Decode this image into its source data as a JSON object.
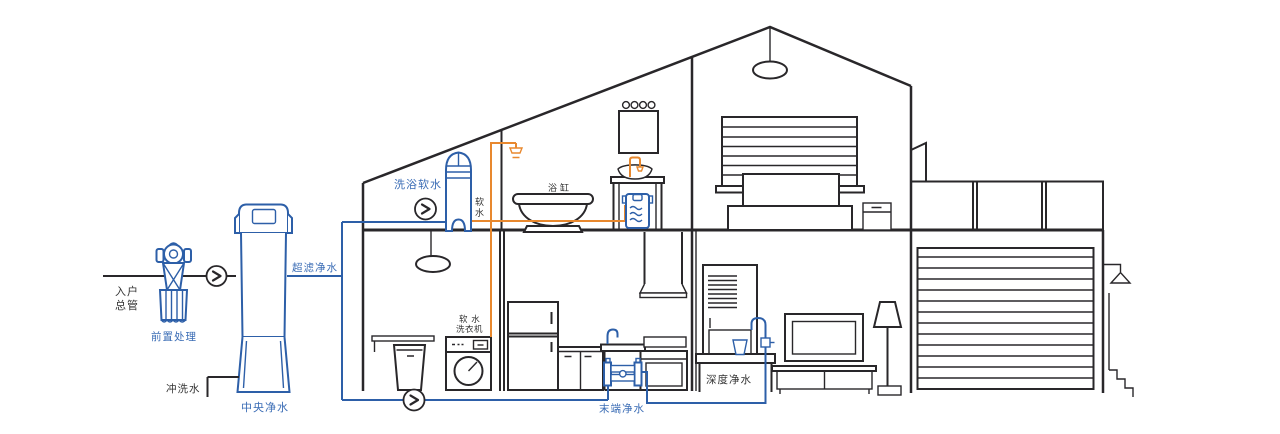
{
  "diagram": {
    "labels": {
      "inlet_line1": "入户",
      "inlet_line2": "总管",
      "pre_treatment": "前置处理",
      "central_purifier": "中央净水",
      "flush_water": "冲洗水",
      "ultrafiltration": "超滤净水",
      "bath_softener": "洗浴软水",
      "soft_water_char1": "软",
      "soft_water_char2": "水",
      "bathtub": "浴缸",
      "washer_line1": "软 水",
      "washer_line2": "洗衣机",
      "terminal_purifier": "末端净水",
      "deep_purifier": "深度净水"
    },
    "colors": {
      "pipe_blue": "#2d5fa8",
      "label_blue": "#3a6cb5",
      "pipe_orange": "#e8882e",
      "line_black": "#29272a",
      "label_black": "#333333"
    }
  }
}
